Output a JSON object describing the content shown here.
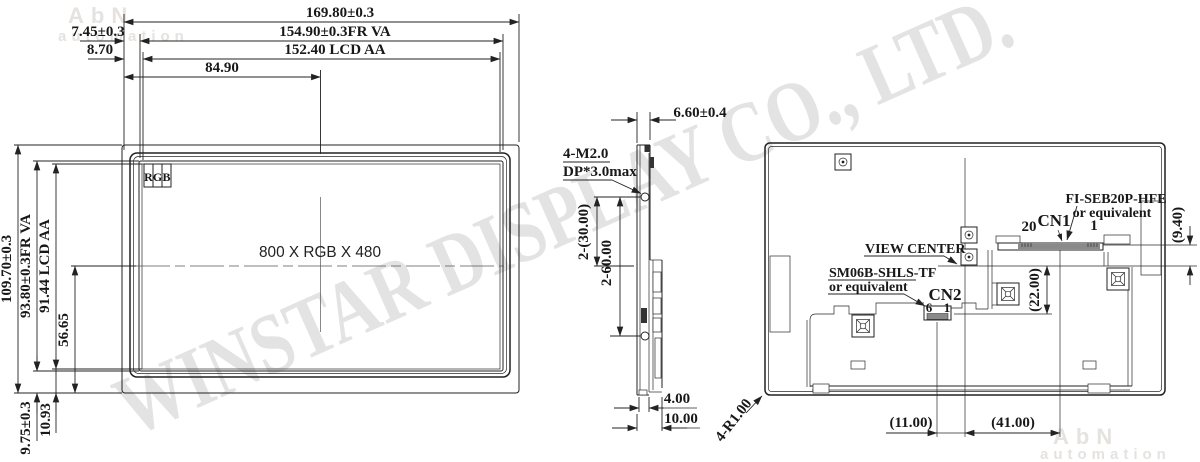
{
  "watermark": {
    "company": "WINSTAR DISPLAY CO., LTD.",
    "brand": "AbN",
    "brand_sub": "automation"
  },
  "front": {
    "overall_width": "169.80±0.3",
    "va_width": "154.90±0.3FR VA",
    "aa_width": "152.40 LCD AA",
    "center_offset_x": "84.90",
    "bezel_offset_left": "7.45±0.3",
    "aa_offset_left": "8.70",
    "overall_height": "109.70±0.3",
    "va_height": "93.80±0.3FR VA",
    "aa_height": "91.44 LCD AA",
    "center_offset_y": "56.65",
    "bottom_margin_va": "9.75±0.3",
    "bottom_margin_aa": "10.93",
    "resolution": "800 X RGB X 480",
    "pixel_r": "R",
    "pixel_g": "G",
    "pixel_b": "B"
  },
  "side": {
    "thickness": "6.60±0.4",
    "screw_note1": "4-M2.0",
    "screw_note2": "DP*3.0max",
    "screw_center_offset": "2-(30.00)",
    "screw_pitch": "2-60.00",
    "pcb_depth": "4.00",
    "total_depth": "10.00"
  },
  "back": {
    "cn1": "CN1",
    "cn1_pin20": "20",
    "cn1_pin1": "1",
    "cn1_note1": "FI-SEB20P-HFE",
    "cn1_note2": "or equivalent",
    "cn2": "CN2",
    "cn2_pin6": "6",
    "cn2_pin1": "1",
    "cn2_note1": "SM06B-SHLS-TF",
    "cn2_note2": "or equivalent",
    "view_center": "VIEW CENTER",
    "cn1_y_offset": "(9.40)",
    "cn2_y_offset": "(22.00)",
    "cn2_x_offset": "(11.00)",
    "cn1_x_offset": "(41.00)",
    "corner_radius": "4-R1.00"
  },
  "colors": {
    "line": "#222222",
    "rgb_r": "#e81f1f",
    "rgb_g": "#1fbf3f",
    "rgb_b": "#2430e0",
    "connector_gray": "#8a8a8a",
    "watermark_gray": "#d3d3d3",
    "brand_gray": "#e5e2df"
  }
}
